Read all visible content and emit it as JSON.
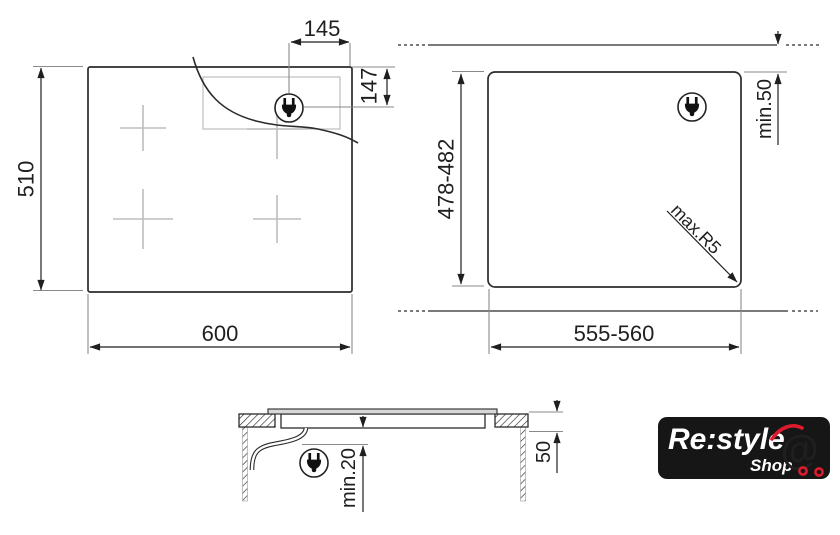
{
  "colors": {
    "line": "#2b2b2b",
    "dimension": "#1f1f1f",
    "extension_gray": "#8a8a8a",
    "detail_gray": "#bdbdbd",
    "glass_fill": "#d8d8d8",
    "logo_bg": "#161616",
    "logo_text": "#ffffff",
    "logo_accent": "#dd1b2d"
  },
  "top_view": {
    "width": "600",
    "height": "510",
    "plug_offset_from_right": "145",
    "plug_offset_from_top": "147"
  },
  "cutout_view": {
    "width": "555-560",
    "depth": "478-482",
    "rear_clearance": "min.50",
    "corner_radius": "max.R5"
  },
  "section_view": {
    "bottom_clearance": "min.20",
    "worktop_thickness": "50"
  },
  "logo": {
    "brand": "Re:style",
    "shop": "Shop",
    "cart_symbol": "@"
  }
}
